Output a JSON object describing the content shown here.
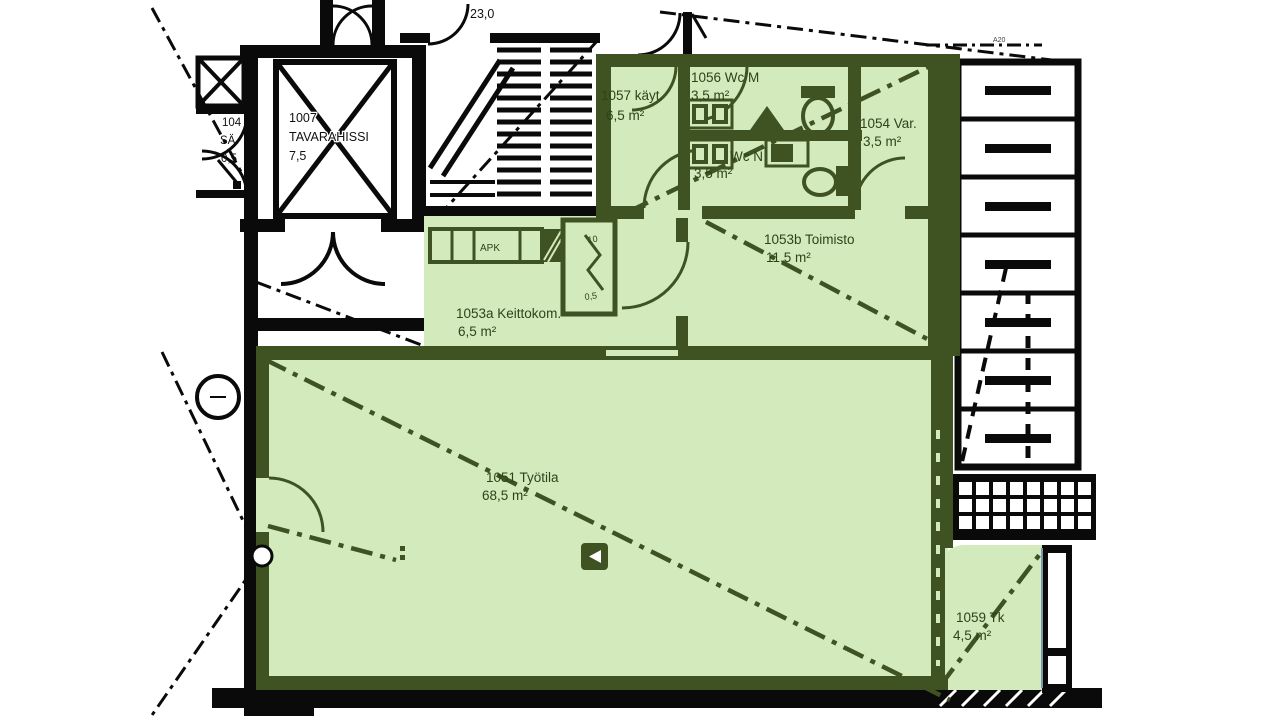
{
  "document": {
    "type_label": "floor-plan"
  },
  "colors": {
    "highlight_fill": "#d3eabd",
    "highlight_wall": "#3e5222",
    "label_green": "#2f421a",
    "linework_black": "#0a0a0a",
    "edge_accent_blue": "#7d97ad",
    "background": "#ffffff"
  },
  "labels": {
    "dim_top": "23,0",
    "apk": "APK",
    "a20": "A20",
    "shaft_top": "10",
    "shaft_area": "0,5"
  },
  "rooms": {
    "tavarahissi": {
      "id": "1007",
      "name": "TAVARAHISSI",
      "area": "7,5"
    },
    "sahkokomero": {
      "id": "104",
      "name": "SÄ",
      "area": "0,5"
    },
    "kaytava": {
      "label": "1057 käyt.",
      "area": "6,5 m²"
    },
    "wc_m": {
      "label": "1056 Wc M",
      "area": "3,5 m²"
    },
    "wc_n": {
      "label": "Wc N",
      "area": "3,5 m²"
    },
    "varasto": {
      "label": "1054 Var.",
      "area": "3,5 m²"
    },
    "toimisto": {
      "label": "1053b Toimisto",
      "area": "11,5 m²"
    },
    "keittokomero": {
      "label": "1053a Keittokom.",
      "area": "6,5 m²"
    },
    "tyotila": {
      "label": "1051 Työtila",
      "area": "68,5 m²"
    },
    "tk": {
      "label": "1059 Tk",
      "area": "4,5 m²"
    }
  }
}
